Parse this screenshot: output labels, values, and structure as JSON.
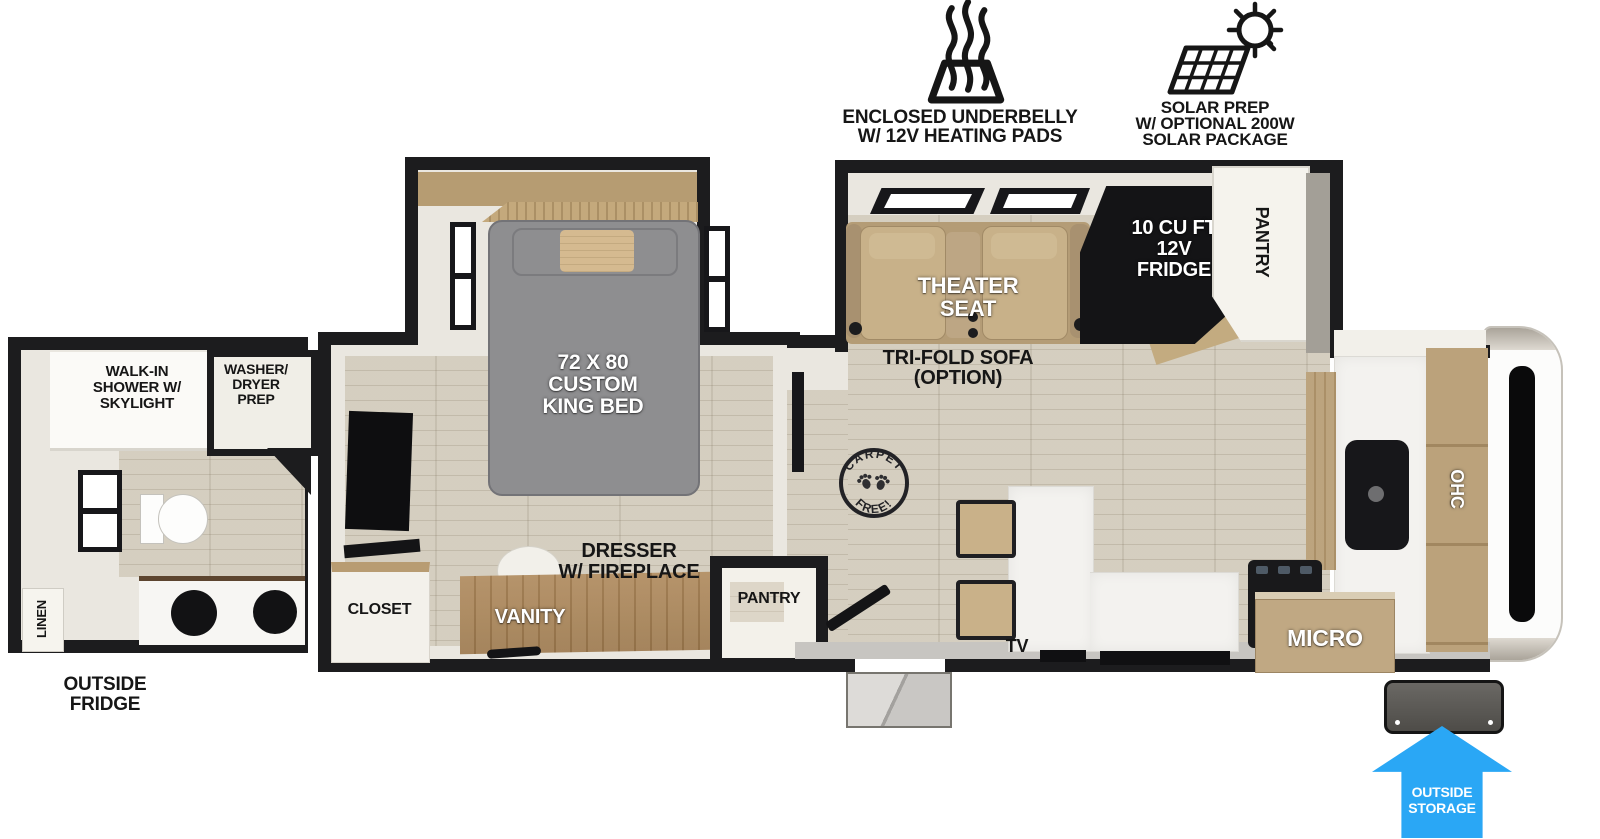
{
  "colors": {
    "wall": "#1c1c1e",
    "interior_cream": "#eae7e0",
    "floor_wood": "#d3ccbd",
    "furniture_wood": "#b59a70",
    "sofa_tan": "#c8b189",
    "bed_gray": "#8e8e90",
    "accent_blue": "#2aa7f5"
  },
  "badges": {
    "underbelly": {
      "icon": "heat-waves-icon",
      "lines": [
        "ENCLOSED UNDERBELLY",
        "W/ 12V HEATING PADS"
      ]
    },
    "solar": {
      "icon": "solar-panel-icon",
      "lines": [
        "SOLAR PREP",
        "W/ OPTIONAL 200W",
        "SOLAR PACKAGE"
      ]
    }
  },
  "rear_bath": {
    "shower_lines": [
      "WALK-IN",
      "SHOWER W/",
      "SKYLIGHT"
    ],
    "washer_dryer_lines": [
      "WASHER/",
      "DRYER",
      "PREP"
    ],
    "linen": "LINEN",
    "outside_fridge_lines": [
      "OUTSIDE",
      "FRIDGE"
    ]
  },
  "bedroom": {
    "bed_lines": [
      "72 X 80",
      "CUSTOM",
      "KING BED"
    ],
    "closet": "CLOSET",
    "vanity": "VANITY",
    "dresser_lines": [
      "DRESSER",
      "W/ FIREPLACE"
    ],
    "pantry": "PANTRY"
  },
  "living": {
    "theater_lines": [
      "THEATER",
      "SEAT"
    ],
    "trifold_lines": [
      "TRI-FOLD SOFA",
      "(OPTION)"
    ],
    "fridge_lines": [
      "10 CU FT",
      "12V",
      "FRIDGE"
    ],
    "pantry": "PANTRY",
    "tv": "TV",
    "stamp": {
      "top": "CARPET",
      "bottom": "FREE!"
    }
  },
  "kitchen": {
    "micro": "MICRO",
    "ohc": "OHC"
  },
  "exterior": {
    "storage_lines": [
      "OUTSIDE",
      "STORAGE"
    ]
  }
}
